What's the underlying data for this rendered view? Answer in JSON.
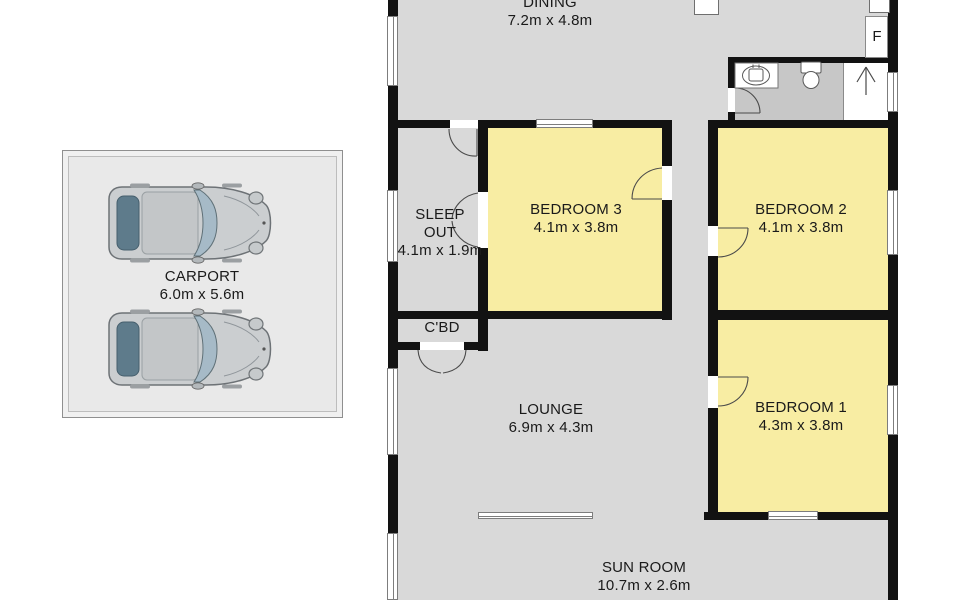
{
  "rooms": {
    "dining": {
      "label": "DINING",
      "dims": "7.2m x 4.8m"
    },
    "sleep_out": {
      "label": "SLEEP OUT",
      "dims": "4.1m x 1.9m"
    },
    "bedroom3": {
      "label": "BEDROOM 3",
      "dims": "4.1m x 3.8m"
    },
    "bedroom2": {
      "label": "BEDROOM 2",
      "dims": "4.1m x 3.8m"
    },
    "bedroom1": {
      "label": "BEDROOM 1",
      "dims": "4.3m x 3.8m"
    },
    "cupboard": {
      "label": "C'BD"
    },
    "lounge": {
      "label": "LOUNGE",
      "dims": "6.9m x 4.3m"
    },
    "sun_room": {
      "label": "SUN ROOM",
      "dims": "10.7m x 2.6m"
    },
    "carport": {
      "label": "CARPORT",
      "dims": "6.0m x 5.6m"
    }
  },
  "annotations": {
    "fridge_label": "F"
  },
  "colors": {
    "bedroom_yellow": "#f8eda3",
    "floor_gray": "#d9d9d9",
    "bathroom_gray": "#c7c7c7",
    "wall_black": "#121212",
    "carport_fill": "#e9e9e9",
    "window_border": "#7d7d7d"
  }
}
